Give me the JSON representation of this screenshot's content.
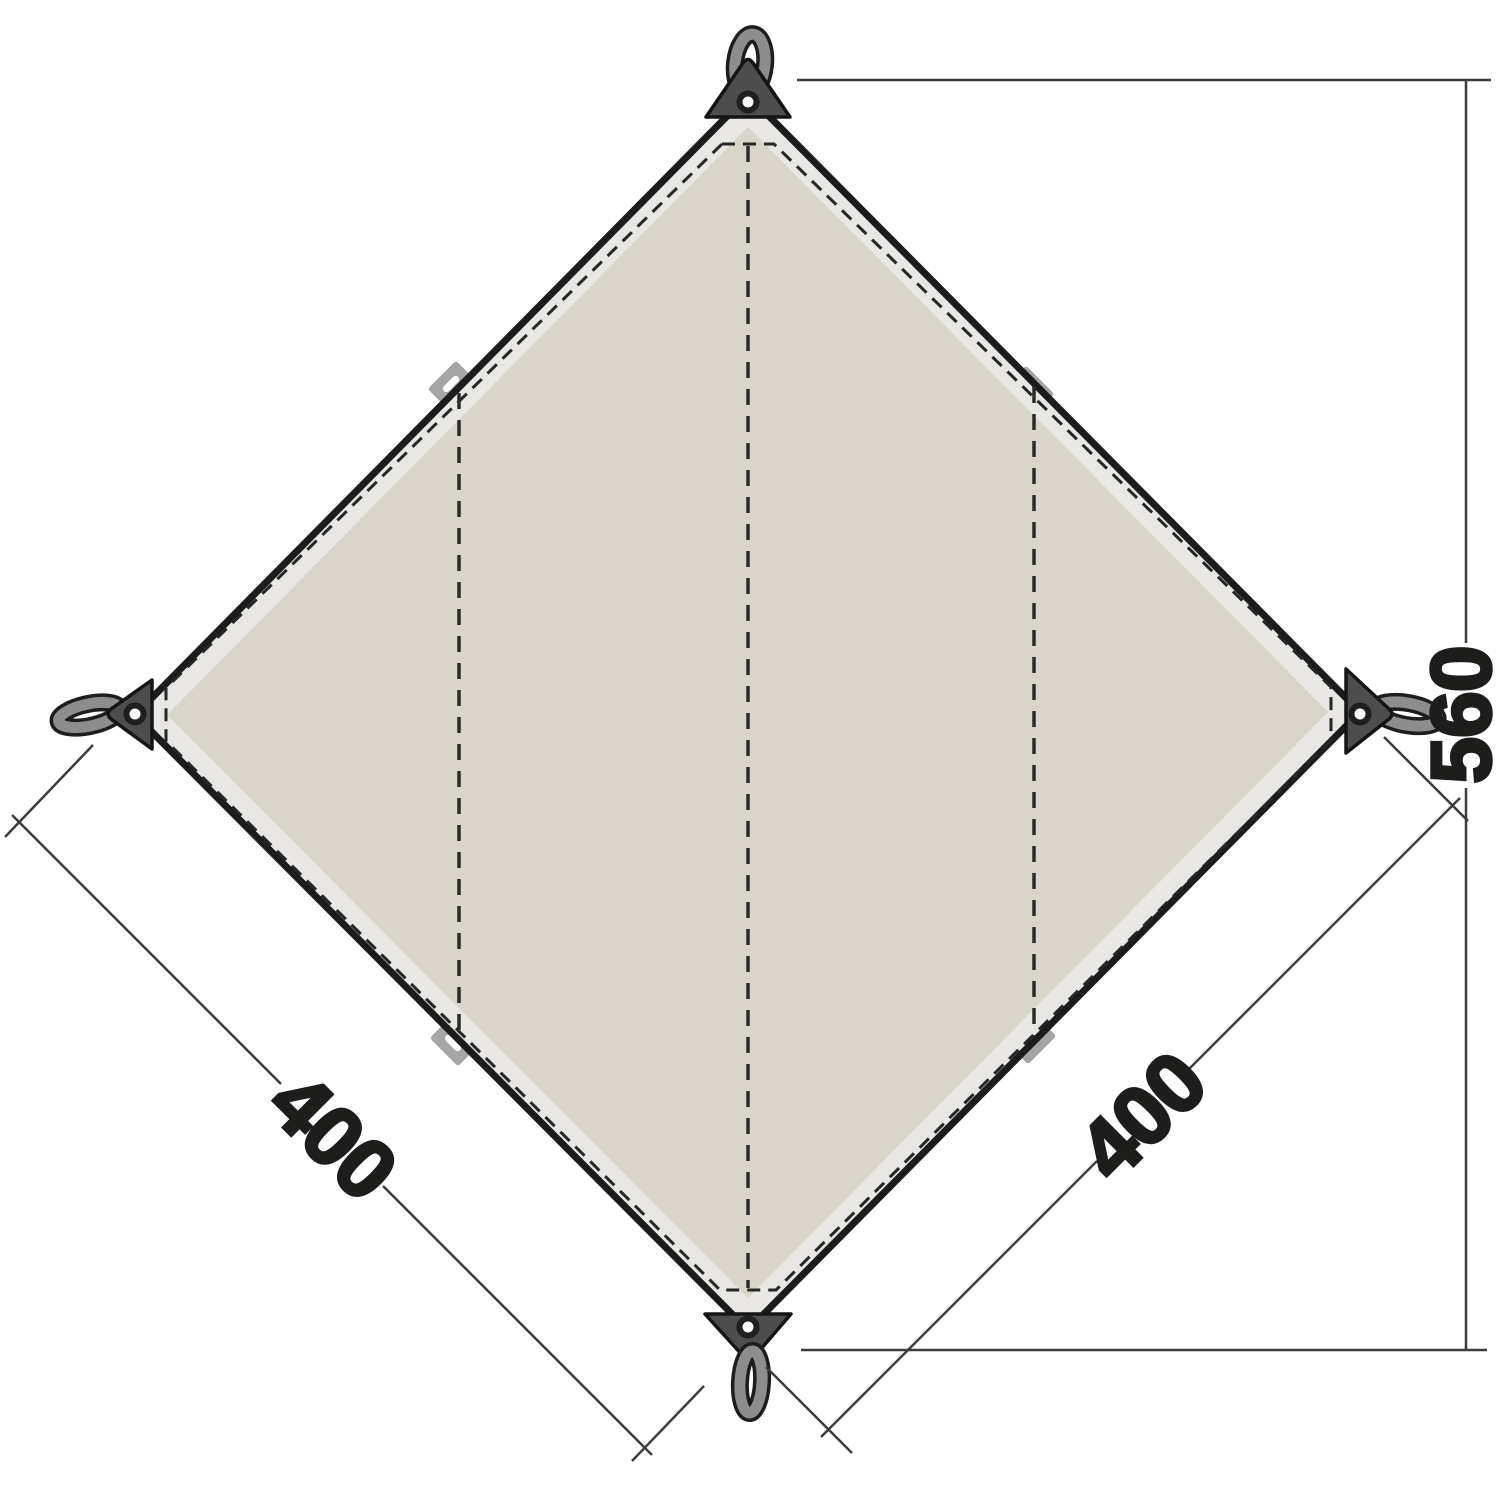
{
  "diagram": {
    "labels": {
      "edge_left": "400",
      "edge_right": "400",
      "diagonal_height": "560"
    },
    "colors": {
      "background": "#ffffff",
      "fabric": "#d9d5c9",
      "binding": "#e8e7e4",
      "edge": "#1c1c1c",
      "stitch_line": "#262626",
      "hardware": "#4d4d4d",
      "strap": "#8d8d8d",
      "strap_outline": "#1d1d1d",
      "tab": "#a5a5a5",
      "tab_slot": "#ffffff",
      "grommet": "#fbfbfb",
      "dimension_line": "#3c3c3c",
      "text": "#1d1d1b"
    }
  }
}
